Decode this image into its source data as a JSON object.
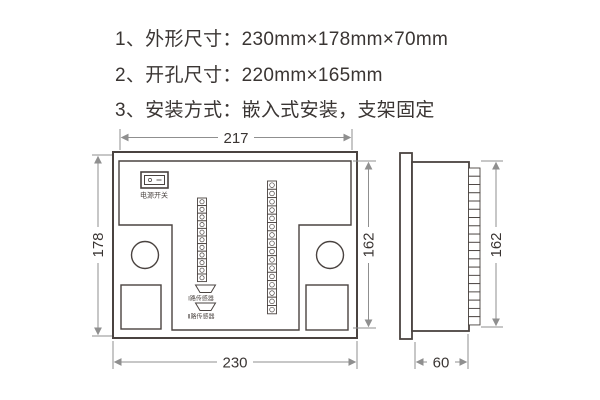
{
  "specs": {
    "line1": "1、外形尺寸：230mm×178mm×70mm",
    "line2": "2、开孔尺寸：220mm×165mm",
    "line3": "3、安装方式：嵌入式安装，支架固定"
  },
  "rear_view": {
    "dim_top": "217",
    "dim_left": "178",
    "dim_right": "162",
    "dim_bottom": "230",
    "power_switch_label": "电源开关",
    "sensor1_label": "Ⅰ路传感器",
    "sensor2_label": "Ⅱ路传感器",
    "left_terminal_count": 11,
    "right_terminal_count": 16
  },
  "side_view": {
    "dim_right": "162",
    "dim_bottom": "60",
    "terminal_count": 19
  },
  "colors": {
    "line": "#4a4340",
    "dim": "#8f8f8f",
    "text": "#3a3533",
    "bg": "#ffffff"
  }
}
